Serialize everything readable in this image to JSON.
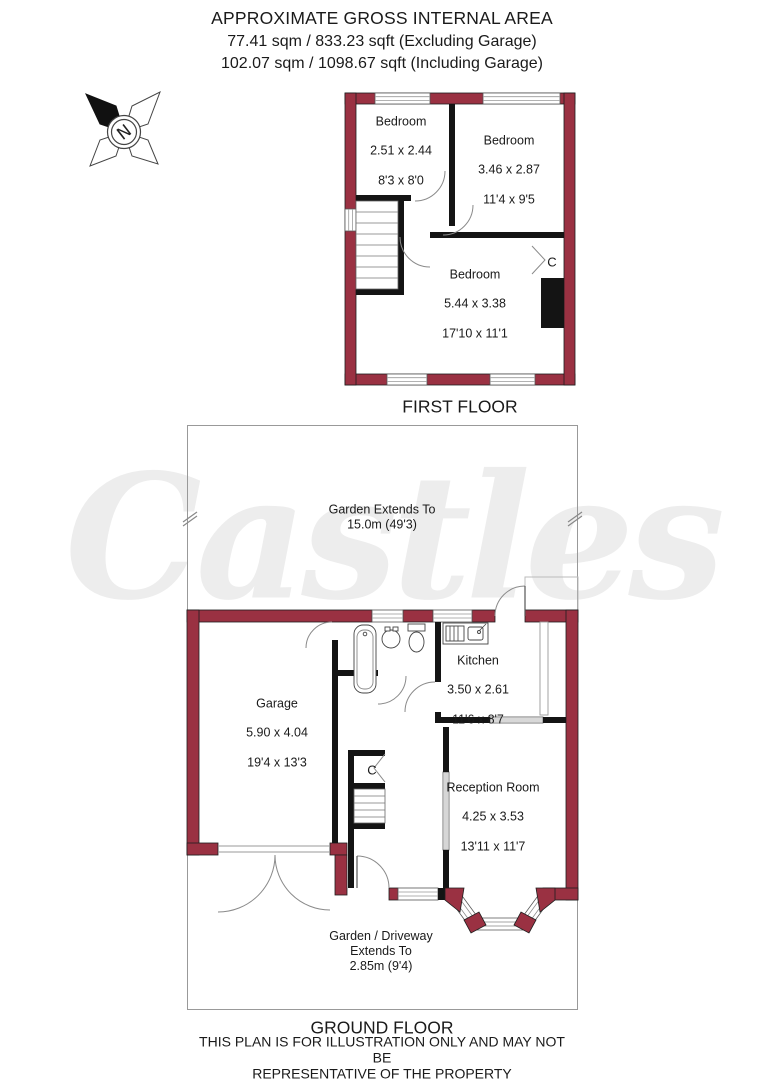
{
  "header": {
    "title": "APPROXIMATE GROSS INTERNAL AREA",
    "area_excluding": "77.41 sqm / 833.23 sqft (Excluding Garage)",
    "area_including": "102.07 sqm / 1098.67 sqft (Including Garage)"
  },
  "compass": {
    "north_label": "N"
  },
  "watermark": "Castles",
  "first_floor": {
    "caption": "FIRST FLOOR",
    "closet_label": "C",
    "rooms": [
      {
        "name": "Bedroom",
        "metric": "2.51 x 2.44",
        "imperial": "8'3 x 8'0"
      },
      {
        "name": "Bedroom",
        "metric": "3.46 x 2.87",
        "imperial": "11'4 x 9'5"
      },
      {
        "name": "Bedroom",
        "metric": "5.44 x 3.38",
        "imperial": "17'10 x 11'1"
      }
    ]
  },
  "ground_floor": {
    "caption": "GROUND FLOOR",
    "closet_label": "C",
    "garden_note": "Garden Extends To\n15.0m (49'3)",
    "driveway_note": "Garden / Driveway\nExtends To\n2.85m (9'4)",
    "rooms": [
      {
        "name": "Garage",
        "metric": "5.90 x 4.04",
        "imperial": "19'4 x 13'3"
      },
      {
        "name": "Kitchen",
        "metric": "3.50 x 2.61",
        "imperial": "11'6 x 8'7"
      },
      {
        "name": "Reception Room",
        "metric": "4.25 x 3.53",
        "imperial": "13'11 x 11'7"
      }
    ]
  },
  "footer": {
    "disclaimer": "THIS PLAN IS FOR ILLUSTRATION ONLY AND MAY NOT BE\nREPRESENTATIVE OF THE PROPERTY"
  },
  "colors": {
    "wall": "#9a3142",
    "interior_wall": "#141414",
    "watermark": "#ededed"
  }
}
